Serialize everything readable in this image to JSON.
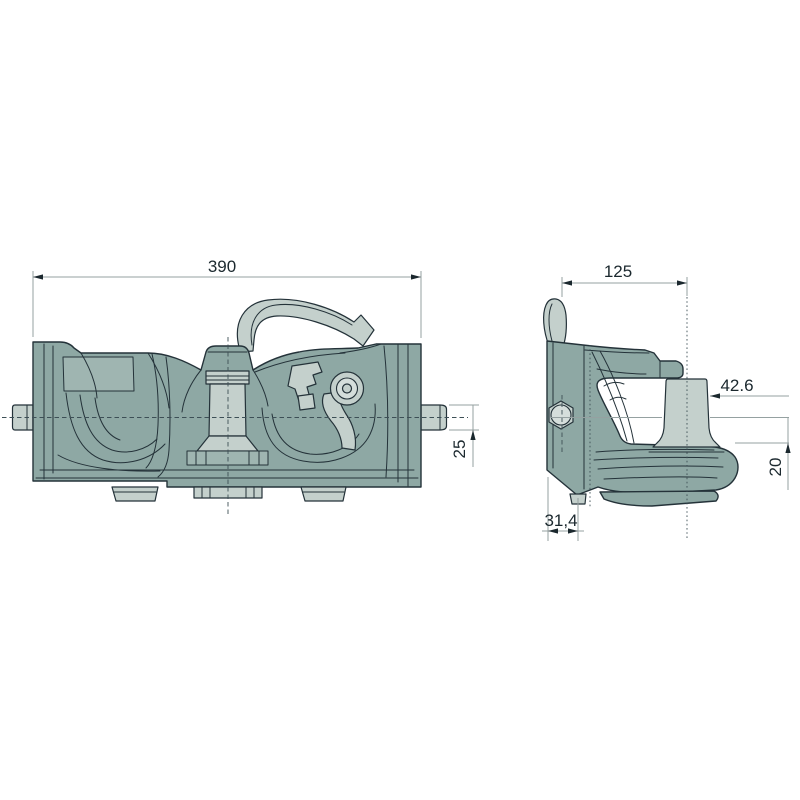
{
  "drawing": {
    "type": "technical-drawing",
    "subject": "trailer-coupling-two-view-drawing",
    "dimensions": {
      "front_width": "390",
      "front_shaft_diameter": "25",
      "side_depth": "125",
      "side_pin_diameter": "42.6",
      "side_drop_height": "20",
      "side_pin_offset": "31,4"
    },
    "palette": {
      "background": "#ffffff",
      "outline": "#243239",
      "body_fill": "#8ea8a4",
      "body_fill_light": "#9fb5b1",
      "body_fill_dark": "#7d9995",
      "metal_fill": "#c4d0cc",
      "metal_fill_light": "#d5dedb",
      "centerline": "#3d4f56",
      "dimension_line": "#95a1a1",
      "dimension_text": "#1b282e"
    }
  }
}
